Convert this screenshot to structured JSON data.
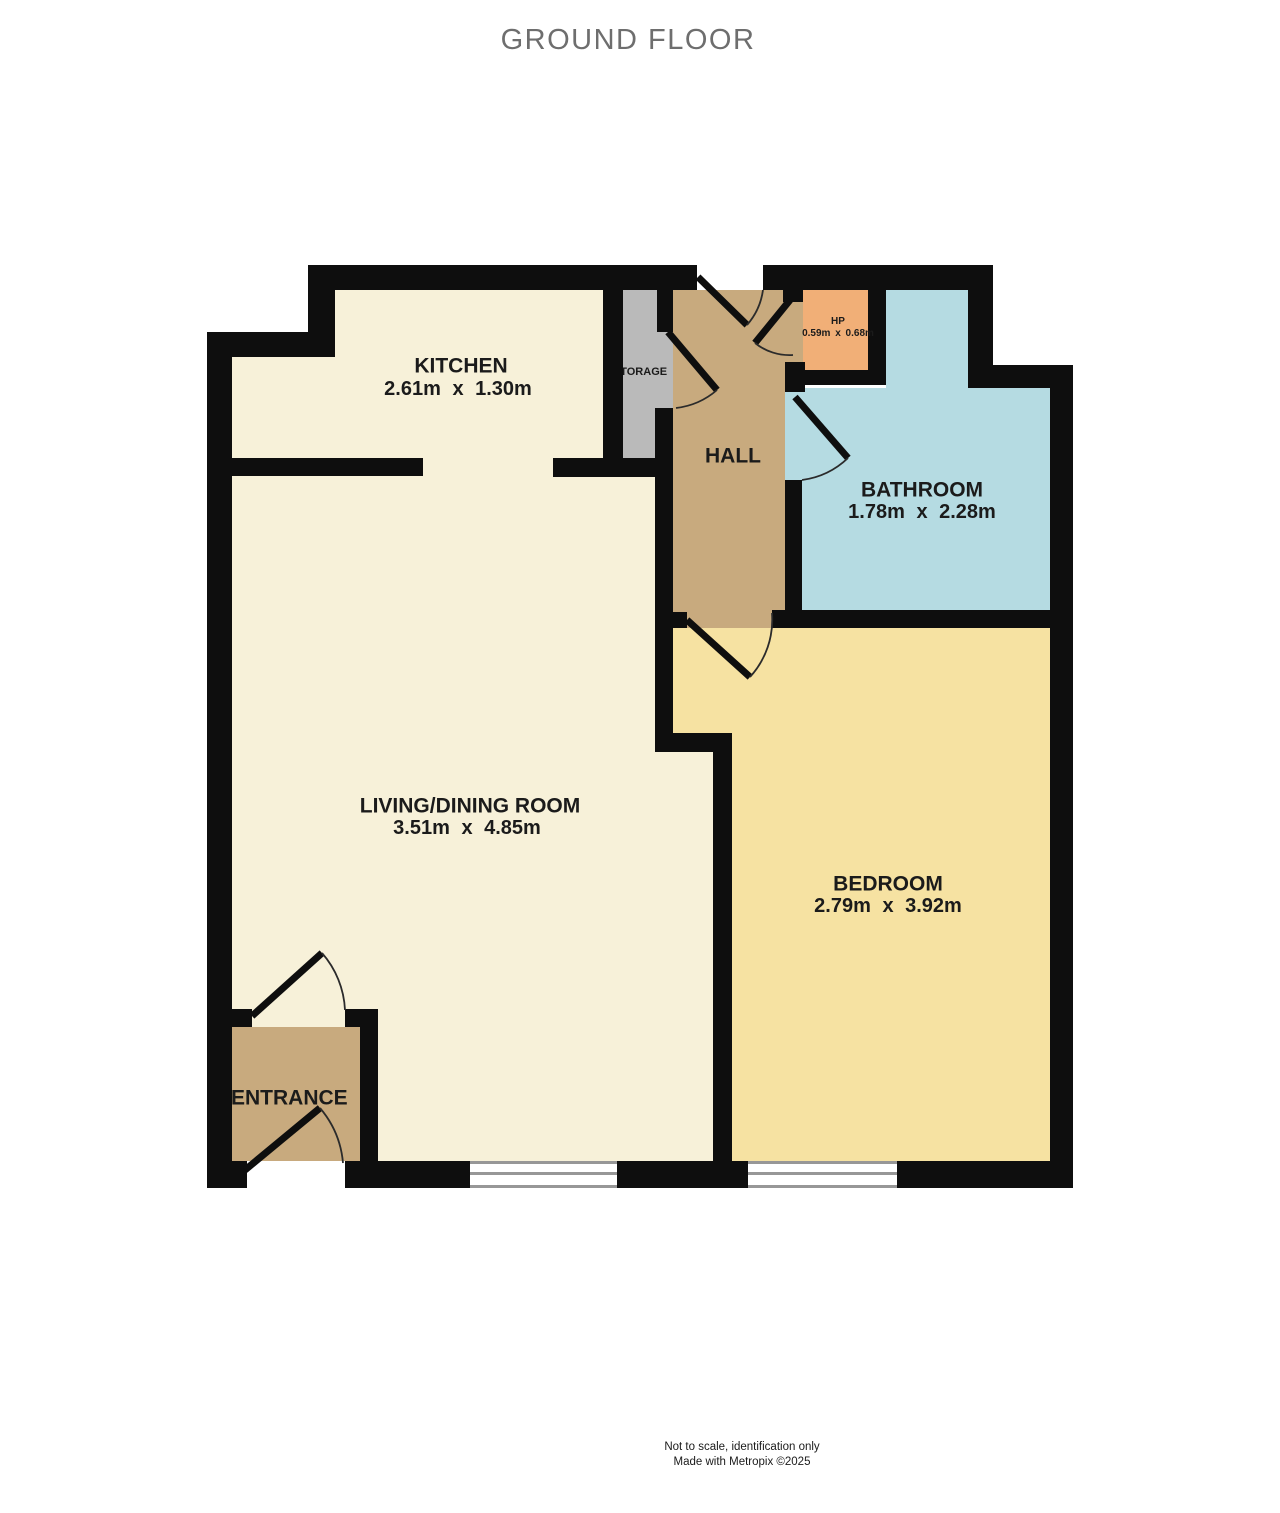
{
  "title": "GROUND FLOOR",
  "rooms": {
    "kitchen": {
      "name": "KITCHEN",
      "dims": "2.61m x 1.30m"
    },
    "storage": {
      "name": "STORAGE"
    },
    "hall": {
      "name": "HALL"
    },
    "hp": {
      "name": "HP",
      "dims": "0.59m x 0.68m"
    },
    "bathroom": {
      "name": "BATHROOM",
      "dims": "1.78m x 2.28m"
    },
    "living": {
      "name": "LIVING/DINING ROOM",
      "dims": "3.51m x 4.85m"
    },
    "bedroom": {
      "name": "BEDROOM",
      "dims": "2.79m x 3.92m"
    },
    "entrance": {
      "name": "ENTRANCE"
    }
  },
  "footer": {
    "line1": "Not to scale, identification only",
    "line2": "Made with Metropix ©2025"
  },
  "colors": {
    "wall": "#0e0e0e",
    "kitchen_living_floor": "#f7f1d9",
    "bedroom_floor": "#f6e2a2",
    "hall_entrance_floor": "#c8aa7e",
    "bathroom_floor": "#b5dbe2",
    "hp_floor": "#f1af77",
    "storage_floor": "#bababa",
    "title_text": "#6e6e6e",
    "label_text": "#1b1b1b"
  }
}
